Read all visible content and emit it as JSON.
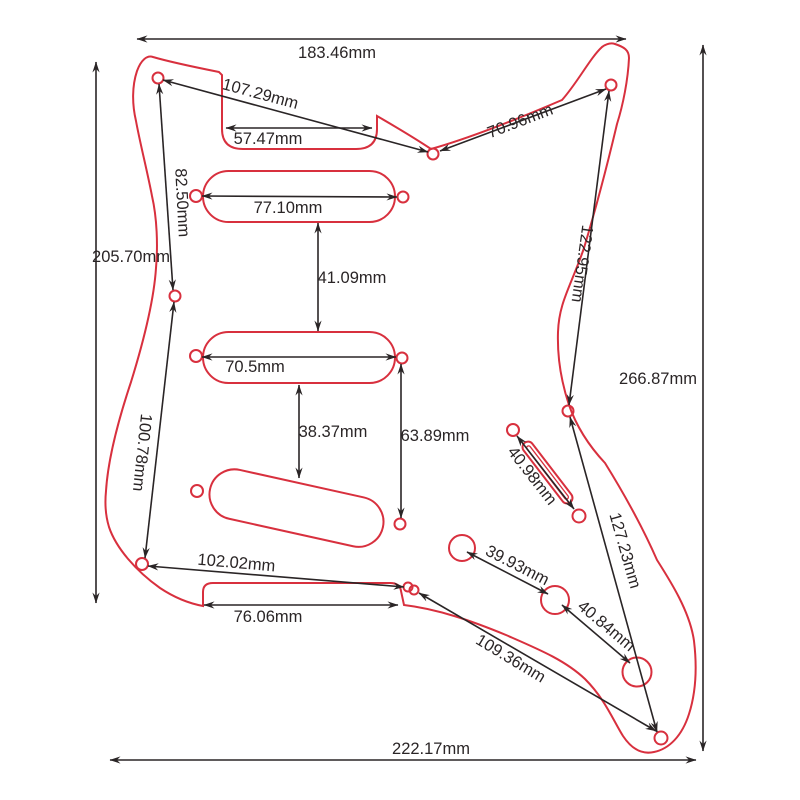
{
  "diagram": {
    "title": "Guitar pickguard dimension drawing",
    "unit": "mm",
    "colors": {
      "outline_red": "#d8303e",
      "dimension_black": "#2a2526",
      "background": "#ffffff"
    },
    "measurements": [
      {
        "id": "overall-top-width",
        "text": "183.46mm"
      },
      {
        "id": "horn-screw-to-center-screw",
        "text": "107.29mm"
      },
      {
        "id": "neck-notch-width",
        "text": "57.47mm"
      },
      {
        "id": "center-screw-to-right-screw",
        "text": "70.96mm"
      },
      {
        "id": "left-screw-spacing-upper",
        "text": "82.50mm"
      },
      {
        "id": "left-overall-height",
        "text": "205.70mm"
      },
      {
        "id": "neck-pickup-screw-span",
        "text": "77.10mm"
      },
      {
        "id": "neck-to-middle-pickup-gap",
        "text": "41.09mm"
      },
      {
        "id": "right-screw-spacing-upper",
        "text": "122.95mm"
      },
      {
        "id": "right-overall-height",
        "text": "266.87mm"
      },
      {
        "id": "middle-pickup-screw-span",
        "text": "70.5mm"
      },
      {
        "id": "left-screw-spacing-lower",
        "text": "100.78mm"
      },
      {
        "id": "middle-to-bridge-pickup-gap",
        "text": "38.37mm"
      },
      {
        "id": "right-pickup-screw-span",
        "text": "63.89mm"
      },
      {
        "id": "switch-slot-screw-span",
        "text": "40.98mm"
      },
      {
        "id": "right-screw-spacing-lower",
        "text": "127.23mm"
      },
      {
        "id": "bottom-left-screw-span",
        "text": "102.02mm"
      },
      {
        "id": "bridge-notch-width",
        "text": "76.06mm"
      },
      {
        "id": "volume-to-tone1-pot",
        "text": "39.93mm"
      },
      {
        "id": "tone1-to-tone2-pot",
        "text": "40.84mm"
      },
      {
        "id": "bridge-screw-diagonal",
        "text": "109.36mm"
      },
      {
        "id": "overall-bottom-width",
        "text": "222.17mm"
      }
    ]
  }
}
